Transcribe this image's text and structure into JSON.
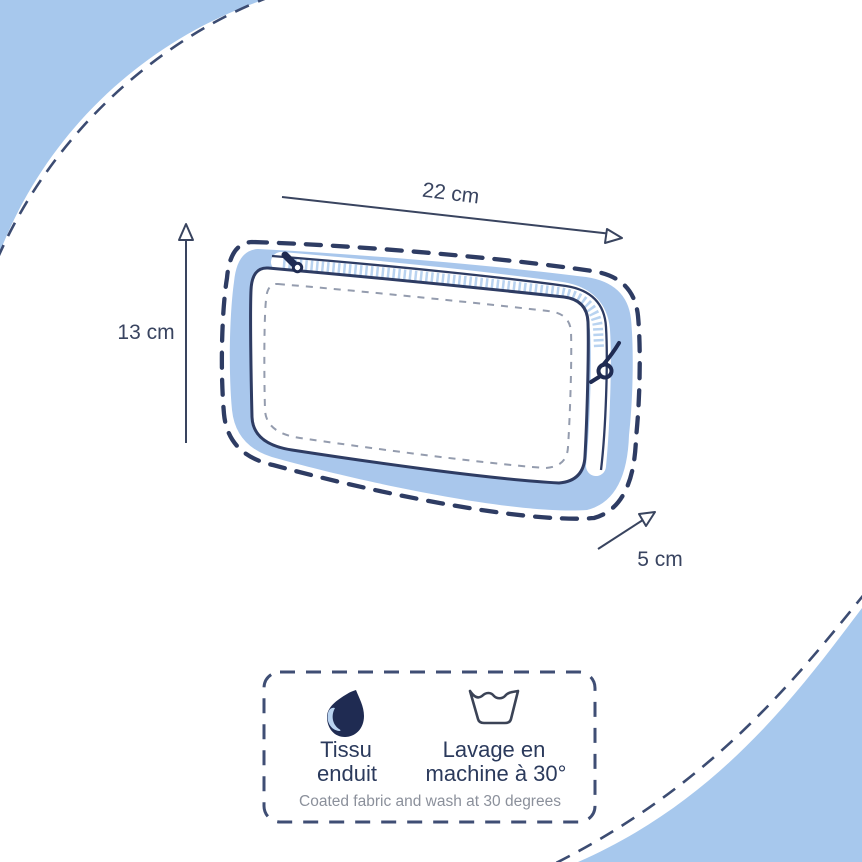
{
  "title": "pouch-dimensions-diagram",
  "colors": {
    "sky_blue": "#a7c8ed",
    "band_blue": "#a9c7ec",
    "teeth_blue": "#b9d3f0",
    "navy_outline": "#2e3c63",
    "pull_navy": "#1f2b52",
    "drop_navy": "#1f2b52",
    "stitch_gray": "#949cae",
    "dim_text": "#394460",
    "french_text": "#2b3a5c",
    "caption_gray": "#8b909b"
  },
  "diagram": {
    "dimensions": {
      "width": "22 cm",
      "height": "13 cm",
      "depth": "5 cm"
    }
  },
  "care_box": {
    "items": [
      {
        "icon": "water-drop-icon",
        "line1": "Tissu",
        "line2": "enduit"
      },
      {
        "icon": "wash-basin-icon",
        "line1": "Lavage en",
        "line2": "machine à 30°"
      }
    ],
    "caption": "Coated fabric and wash at 30 degrees"
  }
}
